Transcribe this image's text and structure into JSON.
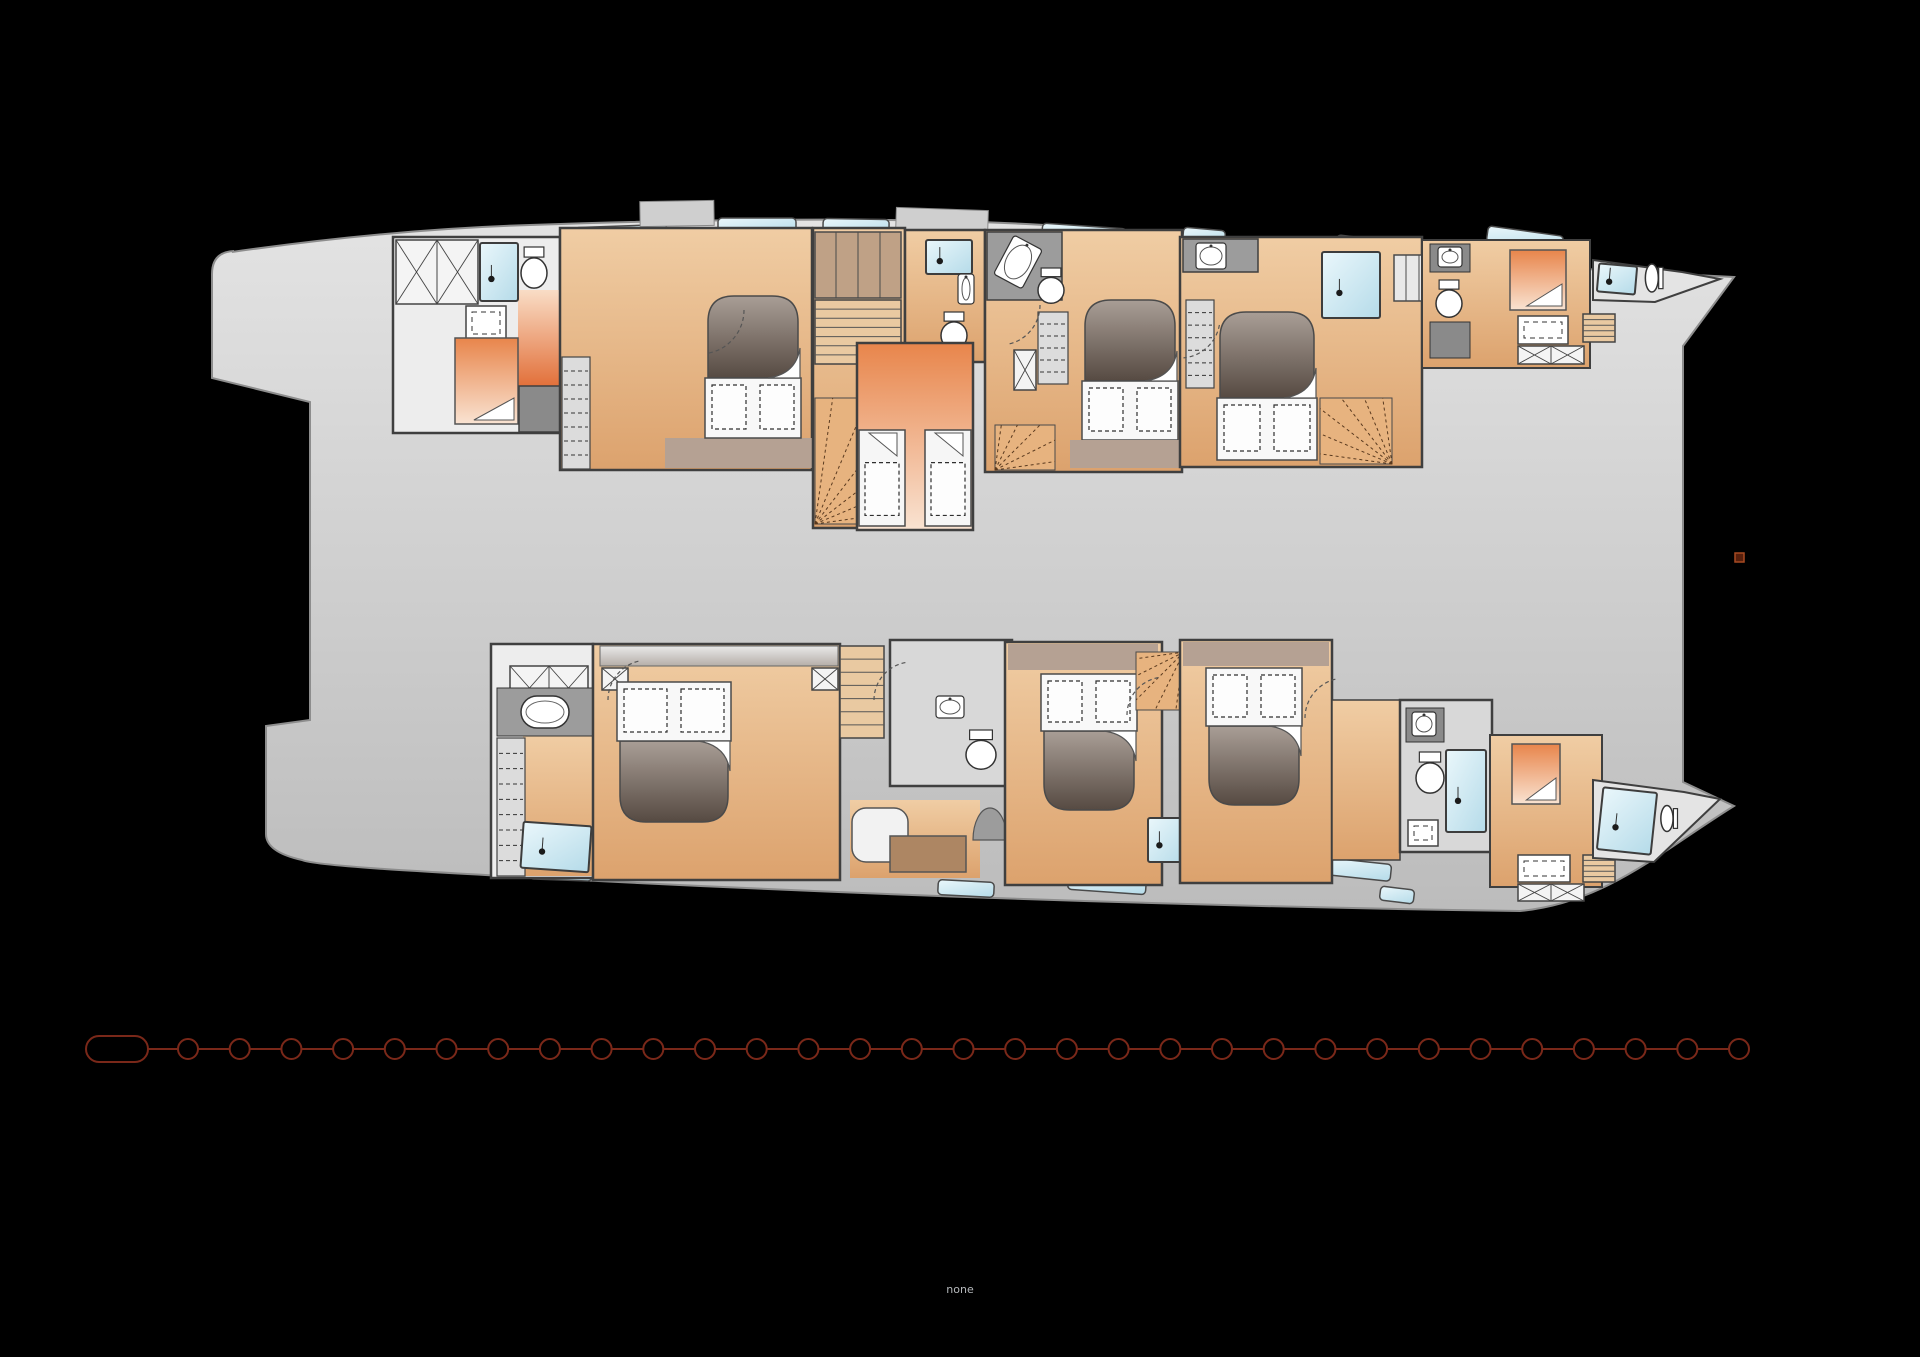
{
  "canvas": {
    "w": 1920,
    "h": 1357,
    "bg": "#000000"
  },
  "bottom_label": {
    "text": "none",
    "x": 960,
    "y": 1293,
    "size": 11,
    "color": "#b5b8bb"
  },
  "marker": {
    "x": 1735,
    "y": 553,
    "w": 9,
    "h": 9,
    "fill": "#571f0c",
    "stroke": "#a84a22"
  },
  "chain": {
    "y": 1049,
    "color": "#7a2819,",
    "stroke": "#7a2819",
    "sw": 2,
    "capsule": {
      "x": 86,
      "y": 1036,
      "w": 62,
      "h": 26,
      "r": 13
    },
    "links": {
      "count": 31,
      "firstCx": 188,
      "spacing": 51.7,
      "r": 10
    }
  },
  "colors": {
    "wall": "#3f3f3f",
    "gradients": {
      "hull": [
        "#e3e3e3",
        "#bcbcbc"
      ],
      "wood": [
        "#f0cda4",
        "#dca26d"
      ],
      "warmDown": [
        "#e8854b",
        "#f9e3d2"
      ],
      "warmUp": [
        "#f9ddc6",
        "#e2703a"
      ],
      "blue": [
        "#eaf7fb",
        "#b5dbe9"
      ],
      "head": [
        "#a99e96",
        "#564a42"
      ],
      "canopy": [
        "#e9e9e9",
        "#b5aea8"
      ]
    }
  },
  "hull": {
    "d": "M 232 252 C 330 238 430 228 530 225 C 700 219 860 218 980 222 C 1120 227 1250 241 1380 254 C 1500 265 1630 272 1734 277 L 1683 346 L 1683 782 L 1734 806 C 1660 852 1605 903 1520 911 C 1240 907 900 897 540 878 C 430 872 315 866 302 860 Q 266 852 266 834 L 266 726 L 310 720 L 310 402 L 212 378 L 212 274 Q 212 252 234 251 Z",
    "fill": "$hull",
    "stroke": "#8d8d8d",
    "sw": 2
  },
  "fixtures": [
    {
      "t": "window",
      "x": 575,
      "y": 226,
      "w": 92,
      "h": 18,
      "r": -2
    },
    {
      "t": "window",
      "x": 718,
      "y": 218,
      "w": 78,
      "h": 16,
      "r": 0
    },
    {
      "t": "window",
      "x": 823,
      "y": 219,
      "w": 66,
      "h": 18,
      "r": 1
    },
    {
      "t": "window",
      "x": 1042,
      "y": 226,
      "w": 84,
      "h": 18,
      "r": 4
    },
    {
      "t": "window",
      "x": 1183,
      "y": 229,
      "w": 42,
      "h": 16,
      "r": 5
    },
    {
      "t": "window",
      "x": 1273,
      "y": 241,
      "w": 62,
      "h": 18,
      "r": 7
    },
    {
      "t": "window",
      "x": 1336,
      "y": 239,
      "w": 70,
      "h": 17,
      "r": 7
    },
    {
      "t": "window",
      "x": 1487,
      "y": 231,
      "w": 76,
      "h": 16,
      "r": 8
    },
    {
      "t": "window",
      "x": 530,
      "y": 866,
      "w": 62,
      "h": 14,
      "r": 2
    },
    {
      "t": "window",
      "x": 938,
      "y": 881,
      "w": 56,
      "h": 15,
      "r": 3
    },
    {
      "t": "window",
      "x": 1068,
      "y": 876,
      "w": 78,
      "h": 16,
      "r": 4
    },
    {
      "t": "window",
      "x": 1325,
      "y": 861,
      "w": 66,
      "h": 17,
      "r": 6
    },
    {
      "t": "window",
      "x": 1380,
      "y": 888,
      "w": 34,
      "h": 14,
      "r": 7
    },
    {
      "t": "rect",
      "x": 640,
      "y": 201,
      "w": 74,
      "h": 25,
      "f": "#cfcfcf",
      "s": "#8a8a8a",
      "sw": 1,
      "r": -1
    },
    {
      "t": "rect",
      "x": 896,
      "y": 209,
      "w": 92,
      "h": 24,
      "f": "#cfcfcf",
      "s": "#8a8a8a",
      "sw": 1,
      "r": 2
    },
    {
      "t": "rect",
      "x": 1408,
      "y": 246,
      "w": 42,
      "h": 18,
      "f": "#cfcfcf",
      "s": "#8a8a8a",
      "sw": 1,
      "r": 8
    },
    {
      "t": "rect",
      "x": 393,
      "y": 237,
      "w": 167,
      "h": 196,
      "f": "#ededed",
      "s": "#3f3f3f",
      "sw": 2.5
    },
    {
      "t": "rect",
      "x": 518,
      "y": 290,
      "w": 42,
      "h": 96,
      "f": "$warmUp"
    },
    {
      "t": "xbox",
      "x": 396,
      "y": 240,
      "w": 82,
      "h": 64,
      "cells": 2
    },
    {
      "t": "shower",
      "x": 480,
      "y": 243,
      "w": 38,
      "h": 58
    },
    {
      "t": "toilet",
      "x": 521,
      "y": 247,
      "w": 26,
      "h": 42
    },
    {
      "t": "sinkbox",
      "x": 466,
      "y": 306,
      "w": 40,
      "h": 34
    },
    {
      "t": "wberth",
      "x": 455,
      "y": 338,
      "w": 63,
      "h": 86
    },
    {
      "t": "rect",
      "x": 519,
      "y": 386,
      "w": 41,
      "h": 46,
      "f": "#8a8a8a",
      "s": "#3f3f3f",
      "sw": 1.5
    },
    {
      "t": "rect",
      "x": 560,
      "y": 228,
      "w": 252,
      "h": 242,
      "f": "$wood",
      "s": "#3f3f3f",
      "sw": 2.5
    },
    {
      "t": "drawers",
      "x": 562,
      "y": 357,
      "w": 28,
      "h": 112,
      "n": 7
    },
    {
      "t": "rect",
      "x": 665,
      "y": 438,
      "w": 148,
      "h": 30,
      "f": "#b5a193"
    },
    {
      "t": "bed",
      "x": 708,
      "y": 296,
      "w": 90,
      "h": 142,
      "dir": "u"
    },
    {
      "t": "arc",
      "cx": 700,
      "cy": 310,
      "rr": 44,
      "a1": 0,
      "a2": 80
    },
    {
      "t": "rect",
      "x": 813,
      "y": 228,
      "w": 92,
      "h": 300,
      "f": "$wood",
      "s": "#3f3f3f",
      "sw": 2.5
    },
    {
      "t": "rect",
      "x": 815,
      "y": 232,
      "w": 86,
      "h": 66,
      "f": "#bfa186",
      "s": "#4a4a4a",
      "sw": 1.5
    },
    {
      "t": "line",
      "x1": 836,
      "y1": 232,
      "x2": 836,
      "y2": 298,
      "s": "#4a4a4a",
      "sw": 1
    },
    {
      "t": "line",
      "x1": 858,
      "y1": 232,
      "x2": 858,
      "y2": 298,
      "s": "#4a4a4a",
      "sw": 1
    },
    {
      "t": "line",
      "x1": 880,
      "y1": 232,
      "x2": 880,
      "y2": 298,
      "s": "#4a4a4a",
      "sw": 1
    },
    {
      "t": "steps",
      "x": 815,
      "y": 300,
      "w": 86,
      "h": 64,
      "n": 6
    },
    {
      "t": "fan",
      "x": 815,
      "y": 398,
      "w": 80,
      "h": 126,
      "apex": "bl",
      "n": 6
    },
    {
      "t": "rect",
      "x": 905,
      "y": 230,
      "w": 80,
      "h": 132,
      "f": "$wood",
      "s": "#3f3f3f",
      "sw": 2.5
    },
    {
      "t": "shower",
      "x": 926,
      "y": 240,
      "w": 46,
      "h": 34
    },
    {
      "t": "sink",
      "x": 958,
      "y": 274,
      "w": 16,
      "h": 30
    },
    {
      "t": "toilet",
      "x": 941,
      "y": 312,
      "w": 26,
      "h": 38
    },
    {
      "t": "poly",
      "p": "857,343 973,343 973,530 857,530",
      "f": "$warmDown",
      "s": "#3f3f3f",
      "sw": 2.5
    },
    {
      "t": "berth",
      "x": 859,
      "y": 430,
      "w": 46,
      "h": 96
    },
    {
      "t": "berth",
      "x": 925,
      "y": 430,
      "w": 46,
      "h": 96
    },
    {
      "t": "rect",
      "x": 985,
      "y": 230,
      "w": 197,
      "h": 242,
      "f": "$wood",
      "s": "#3f3f3f",
      "sw": 2.5
    },
    {
      "t": "poly",
      "p": "987,232 1062,232 1062,300 987,300",
      "f": "#9c9c9c",
      "s": "#3f3f3f",
      "sw": 1.5
    },
    {
      "t": "sink",
      "x": 1002,
      "y": 240,
      "w": 32,
      "h": 44,
      "r": 28
    },
    {
      "t": "toilet",
      "x": 1038,
      "y": 268,
      "w": 26,
      "h": 36
    },
    {
      "t": "drawers",
      "x": 1038,
      "y": 312,
      "w": 30,
      "h": 72,
      "n": 5
    },
    {
      "t": "xbox",
      "x": 1014,
      "y": 350,
      "w": 22,
      "h": 40,
      "cells": 1
    },
    {
      "t": "bed",
      "x": 1085,
      "y": 300,
      "w": 90,
      "h": 140,
      "dir": "u"
    },
    {
      "t": "rect",
      "x": 1070,
      "y": 440,
      "w": 112,
      "h": 28,
      "f": "#b5a193"
    },
    {
      "t": "fan",
      "x": 995,
      "y": 425,
      "w": 60,
      "h": 45,
      "apex": "bl",
      "n": 5
    },
    {
      "t": "arc",
      "cx": 1000,
      "cy": 305,
      "rr": 40,
      "a1": 0,
      "a2": 80
    },
    {
      "t": "rect",
      "x": 1180,
      "y": 237,
      "w": 242,
      "h": 230,
      "f": "$wood",
      "s": "#3f3f3f",
      "sw": 2.5
    },
    {
      "t": "poly",
      "p": "1183,239 1258,239 1258,272 1183,272",
      "f": "#9c9c9c",
      "s": "#3f3f3f",
      "sw": 1.5
    },
    {
      "t": "sink",
      "x": 1196,
      "y": 243,
      "w": 30,
      "h": 26
    },
    {
      "t": "drawers",
      "x": 1186,
      "y": 300,
      "w": 28,
      "h": 88,
      "n": 6
    },
    {
      "t": "bed",
      "x": 1220,
      "y": 312,
      "w": 94,
      "h": 148,
      "dir": "u"
    },
    {
      "t": "shower",
      "x": 1322,
      "y": 252,
      "w": 58,
      "h": 66
    },
    {
      "t": "rect",
      "x": 1394,
      "y": 255,
      "w": 38,
      "h": 46,
      "f": "#e8e8e8",
      "s": "#4a4a4a",
      "sw": 1.5
    },
    {
      "t": "line",
      "x1": 1406,
      "y1": 255,
      "x2": 1406,
      "y2": 301,
      "s": "#4a4a4a",
      "sw": 1
    },
    {
      "t": "line",
      "x1": 1419,
      "y1": 255,
      "x2": 1419,
      "y2": 301,
      "s": "#4a4a4a",
      "sw": 1
    },
    {
      "t": "fan",
      "x": 1320,
      "y": 398,
      "w": 72,
      "h": 66,
      "apex": "br",
      "n": 6
    },
    {
      "t": "arc",
      "cx": 1180,
      "cy": 318,
      "rr": 40,
      "a1": 10,
      "a2": 85
    },
    {
      "t": "rect",
      "x": 1422,
      "y": 240,
      "w": 168,
      "h": 128,
      "f": "$wood",
      "s": "#3f3f3f",
      "sw": 2
    },
    {
      "t": "rect",
      "x": 1430,
      "y": 244,
      "w": 40,
      "h": 28,
      "f": "#8a8a8a",
      "s": "#333333",
      "sw": 1
    },
    {
      "t": "sink",
      "x": 1438,
      "y": 247,
      "w": 24,
      "h": 20
    },
    {
      "t": "toilet",
      "x": 1436,
      "y": 280,
      "w": 26,
      "h": 38
    },
    {
      "t": "rect",
      "x": 1430,
      "y": 322,
      "w": 40,
      "h": 36,
      "f": "#8a8a8a",
      "s": "#333333",
      "sw": 1
    },
    {
      "t": "wberth",
      "x": 1510,
      "y": 250,
      "w": 56,
      "h": 60
    },
    {
      "t": "sinkbox",
      "x": 1518,
      "y": 316,
      "w": 50,
      "h": 28
    },
    {
      "t": "steps",
      "x": 1583,
      "y": 314,
      "w": 32,
      "h": 28,
      "n": 4
    },
    {
      "t": "xbox",
      "x": 1518,
      "y": 346,
      "w": 66,
      "h": 18,
      "cells": 2
    },
    {
      "t": "poly",
      "p": "1593,260 1682,272 1720,279 1655,302 1593,300",
      "f": "#e4e4e4",
      "s": "#3f3f3f",
      "sw": 2
    },
    {
      "t": "shower",
      "x": 1598,
      "y": 265,
      "w": 38,
      "h": 28,
      "r": 5
    },
    {
      "t": "toilet",
      "x": 1640,
      "y": 269,
      "w": 28,
      "h": 18,
      "r": 90
    },
    {
      "t": "rect",
      "x": 491,
      "y": 644,
      "w": 102,
      "h": 234,
      "f": "#ededed",
      "s": "#3f3f3f",
      "sw": 2.5
    },
    {
      "t": "rect",
      "x": 523,
      "y": 734,
      "w": 70,
      "h": 142,
      "f": "$wood"
    },
    {
      "t": "xbox",
      "x": 510,
      "y": 666,
      "w": 78,
      "h": 44,
      "cells": 2
    },
    {
      "t": "rect",
      "x": 497,
      "y": 688,
      "w": 96,
      "h": 48,
      "f": "#9c9c9c",
      "s": "#333333",
      "sw": 1
    },
    {
      "t": "tub",
      "x": 521,
      "y": 696,
      "w": 48,
      "h": 32
    },
    {
      "t": "drawers",
      "x": 497,
      "y": 738,
      "w": 28,
      "h": 138,
      "n": 8
    },
    {
      "t": "shower",
      "x": 522,
      "y": 824,
      "w": 68,
      "h": 46,
      "r": 4
    },
    {
      "t": "rect",
      "x": 593,
      "y": 644,
      "w": 247,
      "h": 236,
      "f": "$wood",
      "s": "#3f3f3f",
      "sw": 2.5
    },
    {
      "t": "canopy",
      "x": 600,
      "y": 646,
      "w": 238,
      "h": 20
    },
    {
      "t": "xbox",
      "x": 602,
      "y": 668,
      "w": 26,
      "h": 22,
      "cells": 1
    },
    {
      "t": "xbox",
      "x": 812,
      "y": 668,
      "w": 26,
      "h": 22,
      "cells": 1
    },
    {
      "t": "bed",
      "x": 620,
      "y": 682,
      "w": 108,
      "h": 140,
      "dir": "d"
    },
    {
      "t": "rect",
      "x": 850,
      "y": 800,
      "w": 130,
      "h": 78,
      "f": "$wood"
    },
    {
      "t": "rect",
      "x": 852,
      "y": 808,
      "w": 56,
      "h": 54,
      "f": "#f2f2f2",
      "s": "#555555",
      "sw": 1.5,
      "rx": 14
    },
    {
      "t": "rect",
      "x": 890,
      "y": 836,
      "w": 76,
      "h": 36,
      "f": "#ad8663",
      "s": "#555555",
      "sw": 1.5
    },
    {
      "t": "arch",
      "x": 973,
      "y": 808,
      "w": 34,
      "h": 32
    },
    {
      "t": "steps",
      "x": 840,
      "y": 646,
      "w": 44,
      "h": 92,
      "n": 6
    },
    {
      "t": "rect",
      "x": 890,
      "y": 640,
      "w": 122,
      "h": 146,
      "f": "#d8d8d8",
      "s": "#3f3f3f",
      "sw": 2.5
    },
    {
      "t": "sink",
      "x": 936,
      "y": 696,
      "w": 28,
      "h": 22
    },
    {
      "t": "toilet",
      "x": 966,
      "y": 730,
      "w": 30,
      "h": 40
    },
    {
      "t": "rect",
      "x": 1005,
      "y": 642,
      "w": 157,
      "h": 243,
      "f": "$wood",
      "s": "#3f3f3f",
      "sw": 2.5
    },
    {
      "t": "rect",
      "x": 1008,
      "y": 644,
      "w": 150,
      "h": 26,
      "f": "#b5a193"
    },
    {
      "t": "bed",
      "x": 1044,
      "y": 674,
      "w": 90,
      "h": 136,
      "dir": "d"
    },
    {
      "t": "fan",
      "x": 1136,
      "y": 652,
      "w": 48,
      "h": 58,
      "apex": "tr",
      "n": 5
    },
    {
      "t": "shower",
      "x": 1148,
      "y": 818,
      "w": 38,
      "h": 44
    },
    {
      "t": "rect",
      "x": 1180,
      "y": 640,
      "w": 152,
      "h": 243,
      "f": "$wood",
      "s": "#3f3f3f",
      "sw": 2.5
    },
    {
      "t": "rect",
      "x": 1183,
      "y": 642,
      "w": 146,
      "h": 24,
      "f": "#b5a193"
    },
    {
      "t": "bed",
      "x": 1209,
      "y": 668,
      "w": 90,
      "h": 137,
      "dir": "d"
    },
    {
      "t": "rect",
      "x": 1332,
      "y": 700,
      "w": 68,
      "h": 160,
      "f": "$wood",
      "s": "#3f3f3f",
      "sw": 1.5
    },
    {
      "t": "rect",
      "x": 1400,
      "y": 700,
      "w": 92,
      "h": 152,
      "f": "#d8d8d8",
      "s": "#3f3f3f",
      "sw": 2.5
    },
    {
      "t": "rect",
      "x": 1406,
      "y": 708,
      "w": 38,
      "h": 34,
      "f": "#8a8a8a",
      "s": "#333333",
      "sw": 1
    },
    {
      "t": "sink",
      "x": 1412,
      "y": 712,
      "w": 24,
      "h": 24
    },
    {
      "t": "toilet",
      "x": 1416,
      "y": 752,
      "w": 28,
      "h": 42
    },
    {
      "t": "sinkbox",
      "x": 1408,
      "y": 820,
      "w": 30,
      "h": 26
    },
    {
      "t": "shower",
      "x": 1446,
      "y": 750,
      "w": 40,
      "h": 82
    },
    {
      "t": "rect",
      "x": 1490,
      "y": 735,
      "w": 112,
      "h": 152,
      "f": "$wood",
      "s": "#3f3f3f",
      "sw": 2
    },
    {
      "t": "wberth",
      "x": 1512,
      "y": 744,
      "w": 48,
      "h": 60
    },
    {
      "t": "sinkbox",
      "x": 1518,
      "y": 855,
      "w": 52,
      "h": 27
    },
    {
      "t": "steps",
      "x": 1583,
      "y": 855,
      "w": 32,
      "h": 27,
      "n": 4
    },
    {
      "t": "xbox",
      "x": 1518,
      "y": 884,
      "w": 66,
      "h": 17,
      "cells": 2
    },
    {
      "t": "poly",
      "p": "1593,780 1684,792 1720,799 1654,862 1593,858",
      "f": "#e4e4e4",
      "s": "#3f3f3f",
      "sw": 2
    },
    {
      "t": "shower",
      "x": 1600,
      "y": 790,
      "w": 54,
      "h": 62,
      "r": 6
    },
    {
      "t": "toilet",
      "x": 1656,
      "y": 810,
      "w": 26,
      "h": 17,
      "r": 90
    },
    {
      "t": "arc",
      "cx": 648,
      "cy": 700,
      "rr": 40,
      "a1": 180,
      "a2": 260
    },
    {
      "t": "arc",
      "cx": 912,
      "cy": 700,
      "rr": 38,
      "a1": 180,
      "a2": 260
    },
    {
      "t": "arc",
      "cx": 1165,
      "cy": 715,
      "rr": 38,
      "a1": 180,
      "a2": 260
    },
    {
      "t": "arc",
      "cx": 1345,
      "cy": 718,
      "rr": 40,
      "a1": 180,
      "a2": 260
    }
  ]
}
